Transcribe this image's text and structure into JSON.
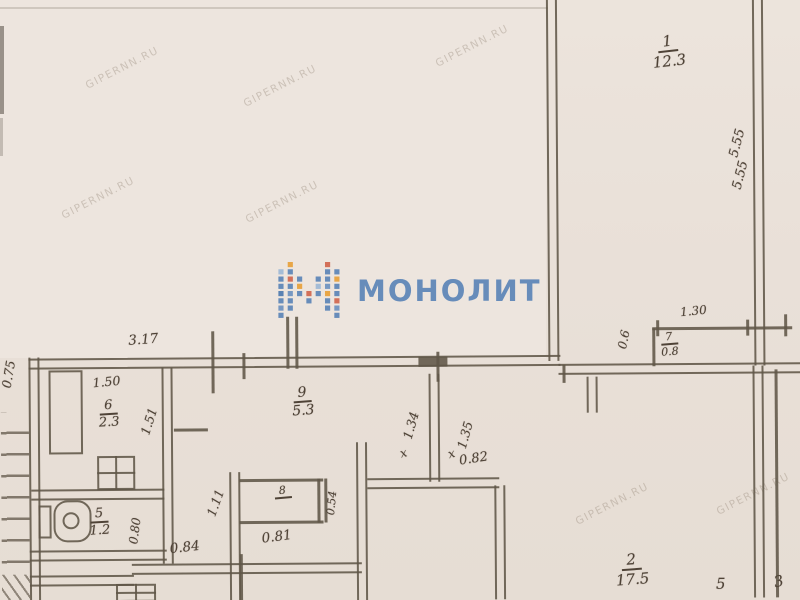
{
  "document": {
    "type": "apartment floor plan scan",
    "colors": {
      "paper": "#e8dfd6",
      "paper_light": "#ede5de",
      "pencil_line": "#60564a",
      "logo_blue": "#5d86b8",
      "logo_orange": "#e8a23c",
      "logo_red": "#d2684f",
      "watermark_gray": "#9e9081"
    }
  },
  "watermark": {
    "text": "GIPERNN.RU"
  },
  "logo": {
    "text": "МОНОЛИТ"
  },
  "rooms": {
    "room1": {
      "number": "1",
      "area": "12.3"
    },
    "room2": {
      "number": "2",
      "area": "17.5"
    },
    "room5": {
      "number": "5",
      "area": "1.2"
    },
    "room6": {
      "number": "6",
      "area": "2.3"
    },
    "room7": {
      "number": "7",
      "area": "0.8"
    },
    "room8": {
      "number": "8",
      "area": ""
    },
    "room9": {
      "number": "9",
      "area": "5.3"
    }
  },
  "dimensions": {
    "top_width": "3.17",
    "left_height": "0.75",
    "bath_width": "1.50",
    "bath_height": "1.51",
    "room1_depth_a": "5.55",
    "room1_depth_b": "5.55",
    "room7_width": "1.30",
    "room7_height": "0.6",
    "hall_left": "1.34",
    "hall_right": "1.35",
    "door_a": "0.82",
    "door_b": "0.81",
    "door_c": "0.84",
    "wc_width": "0.80",
    "hall_height": "1.11",
    "closet_width": "0.54",
    "edge_a": "5",
    "edge_b": "3"
  },
  "marks": {
    "door_cross": "х"
  }
}
